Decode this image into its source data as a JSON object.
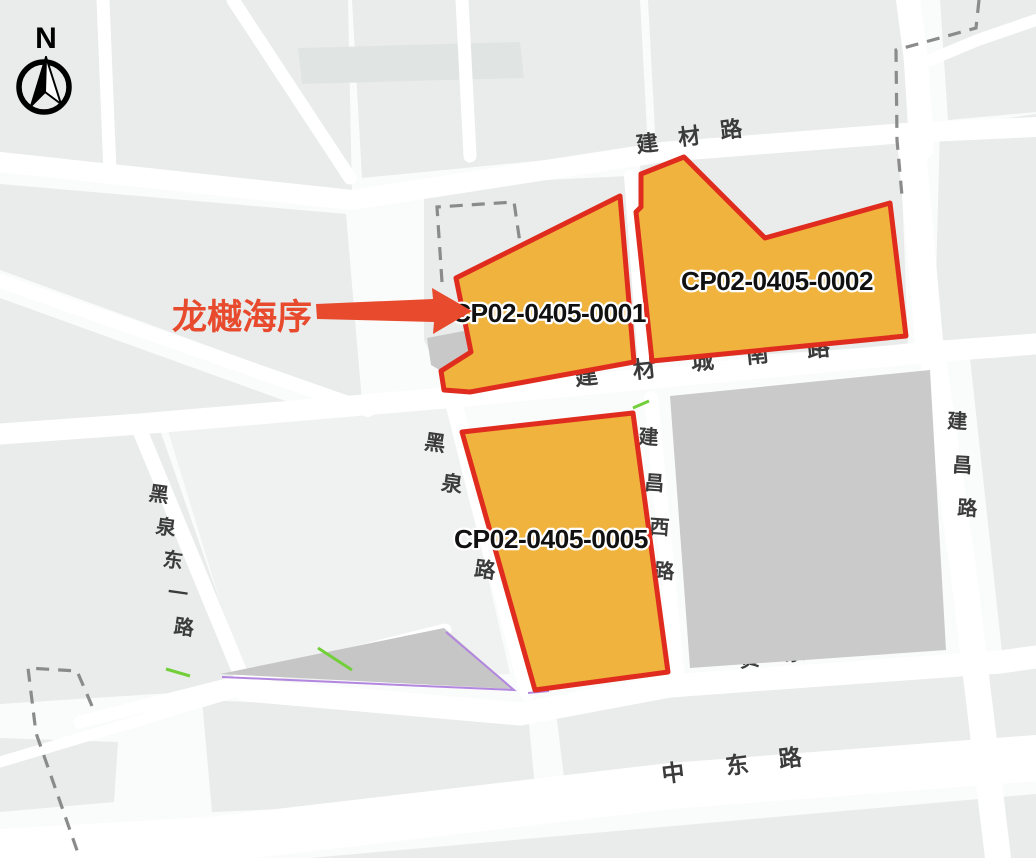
{
  "colors": {
    "background": "#fafbfb",
    "block": "#e9eceb",
    "block_light": "#f0f2f1",
    "road": "#ffffff",
    "gray_block": "#cacaca",
    "gray_wedge": "#c6c6c6",
    "gray_small": "#c8c8c8",
    "parcel_fill": "#f0b33e",
    "parcel_border": "#e02c1f",
    "annotation": "#e84a2d",
    "road_label": "#3b3b3b",
    "parcel_label": "#111111",
    "dashed_line": "#8b8b8b",
    "green_line": "#72cf3a",
    "purple_line": "#b387e0",
    "compass": "#000000"
  },
  "compass": {
    "north_label": "N"
  },
  "annotation": {
    "label": "龙樾海序"
  },
  "parcels": [
    {
      "code": "CP02-0405-0001"
    },
    {
      "code": "CP02-0405-0002"
    },
    {
      "code": "CP02-0405-0005"
    }
  ],
  "roads": {
    "jiancai_lu": {
      "name": "建材路",
      "chars": [
        "建",
        "材",
        "路"
      ]
    },
    "jiancaicheng_nan_lu": {
      "name": "建材城南路",
      "chars": [
        "建",
        "材",
        "城",
        "南",
        "路"
      ]
    },
    "heiquan_lu": {
      "name": "黑泉路",
      "chars": [
        "黑",
        "泉",
        "路"
      ]
    },
    "heiquan_dongyi_lu": {
      "name": "黑泉东一路",
      "chars": [
        "黑",
        "泉",
        "东",
        "一",
        "路"
      ]
    },
    "jianchang_xi_lu": {
      "name": "建昌西路",
      "chars": [
        "建",
        "昌",
        "西",
        "路"
      ]
    },
    "jianchang_lu": {
      "name": "建昌路",
      "chars": [
        "建",
        "昌",
        "路"
      ]
    },
    "hejiacun_lu": {
      "name": "贺家村路",
      "chars": [
        "贺",
        "家",
        "村",
        "路"
      ]
    },
    "zhongdong_lu": {
      "name": "中东路",
      "chars": [
        "中",
        "东",
        "路"
      ]
    }
  }
}
